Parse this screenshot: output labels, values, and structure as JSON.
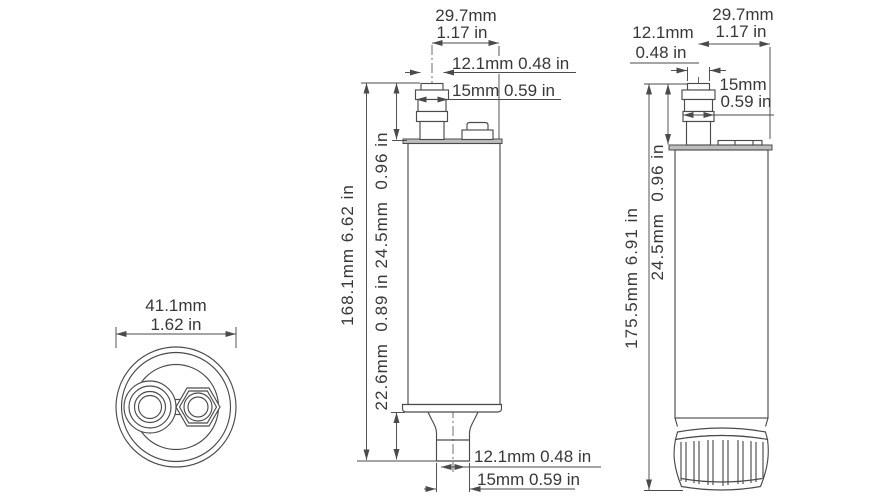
{
  "meta": {
    "background": "#ffffff",
    "line_color": "#4b4b4b",
    "text_color": "#383838",
    "plate_fill": "#bdbdbd"
  },
  "top_view": {
    "diameter_mm": "41.1mm",
    "diameter_in": "1.62 in"
  },
  "front_view": {
    "outlet_offset_mm": "29.7mm",
    "outlet_offset_in": "1.17 in",
    "outlet_inner": "12.1mm 0.48 in",
    "outlet_outer": "15mm 0.59 in",
    "overall_height": "168.1mm 6.62 in",
    "outlet_height": "24.5mm  0.96 in",
    "spout_height": "22.6mm  0.89 in",
    "spout_inner": "12.1mm 0.48 in",
    "spout_outer": "15mm 0.59 in"
  },
  "side_view": {
    "inlet_inner_mm": "12.1mm",
    "inlet_inner_in": "0.48 in",
    "inlet_offset_mm": "29.7mm",
    "inlet_offset_in": "1.17 in",
    "inlet_outer_mm": "15mm",
    "inlet_outer_in": "0.59 in",
    "overall_height": "175.5mm 6.91 in",
    "inlet_height": "24.5mm  0.96 in"
  }
}
